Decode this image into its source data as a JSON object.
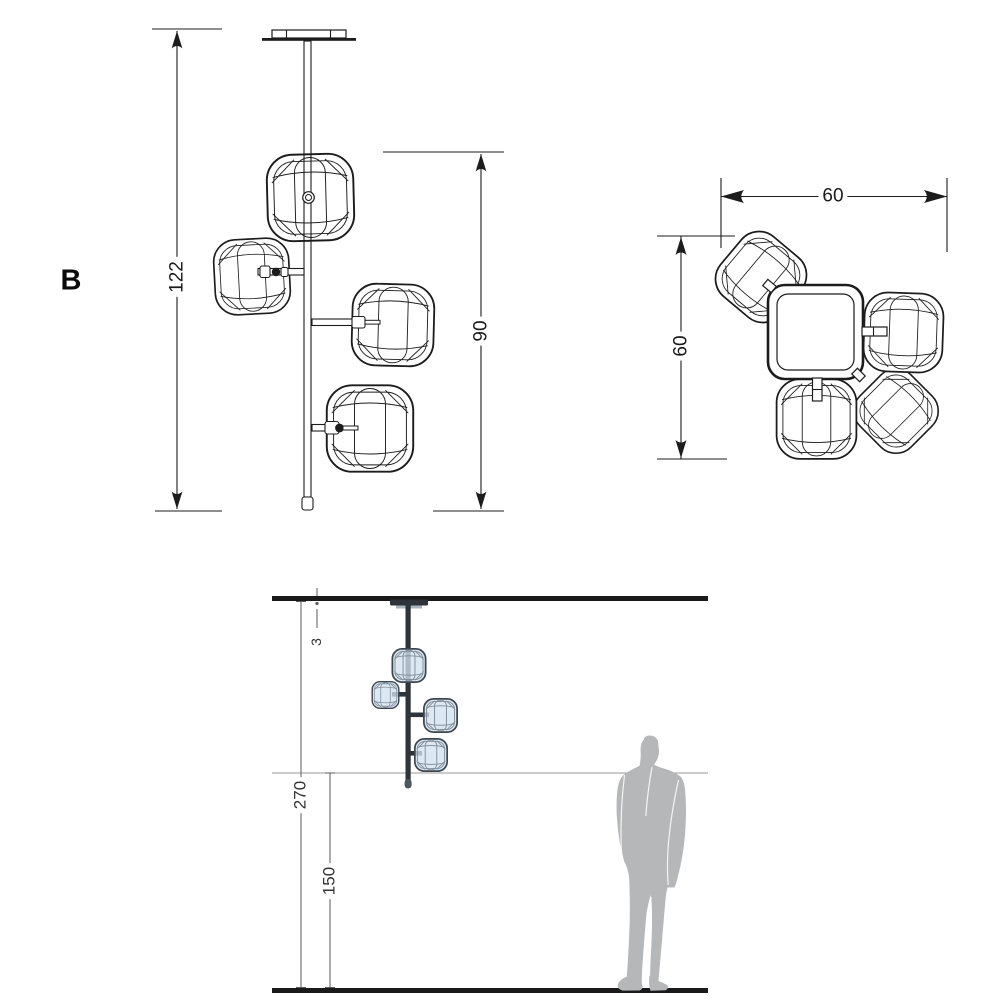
{
  "page": {
    "type": "product dimension drawing",
    "product": "ceiling pendant lamp with four cube glass shades",
    "background": "#ffffff"
  },
  "variant": {
    "label": "B"
  },
  "front_view": {
    "dim_total_drop": "122",
    "dim_shade_stack": "90",
    "shade_count": 4
  },
  "top_view": {
    "dim_width": "60",
    "dim_depth": "60"
  },
  "installation_view": {
    "dim_canopy_offset": "3",
    "dim_ceiling_to_floor": "270",
    "dim_floor_clearance": "150",
    "has_person_silhouette": true
  },
  "colors": {
    "line": "#1c1c1c",
    "dim_line_secondary": "#5a5a5a",
    "glass_fill": "#d9e5ee",
    "glass_outline": "#3c4650",
    "structure_dark": "#2e343a",
    "person_gray": "#b5b7b9",
    "reference_line": "#999999"
  }
}
